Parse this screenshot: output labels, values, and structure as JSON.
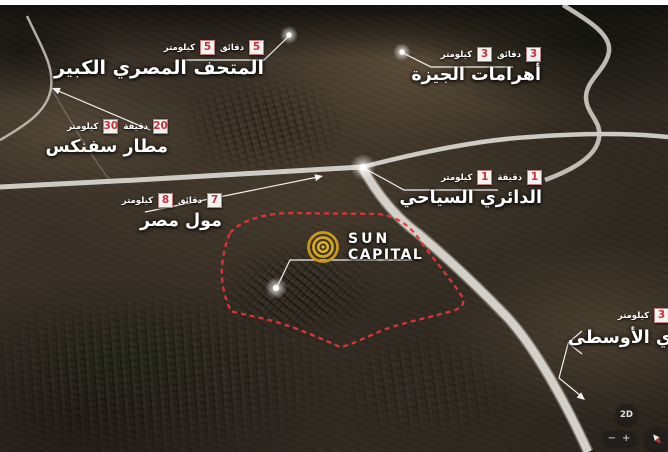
{
  "logo": {
    "line1": "SUN",
    "line2": "CAPITAL"
  },
  "landmarks": [
    {
      "id": "grand-egyptian-museum",
      "name": "المتحف المصري الكبير",
      "minutes": "5",
      "minutes_unit": "دقائق",
      "km": "5",
      "km_unit": "كيلومتر"
    },
    {
      "id": "giza-pyramids",
      "name": "أهرامات الجيزة",
      "minutes": "3",
      "minutes_unit": "دقائق",
      "km": "3",
      "km_unit": "كيلومتر"
    },
    {
      "id": "sphinx-airport",
      "name": "مطار سفنكس",
      "minutes": "20",
      "minutes_unit": "دقيقة",
      "km": "30",
      "km_unit": "كيلومتر"
    },
    {
      "id": "tourist-ring-road",
      "name": "الدائري السياحي",
      "minutes": "1",
      "minutes_unit": "دقيقة",
      "km": "1",
      "km_unit": "كيلومتر"
    },
    {
      "id": "mall-of-egypt",
      "name": "مول مصر",
      "minutes": "7",
      "minutes_unit": "دقائق",
      "km": "8",
      "km_unit": "كيلومتر"
    },
    {
      "id": "middle-ring-road",
      "name": "الدائري الأوسطى",
      "minutes": "3",
      "minutes_unit": "دقائق",
      "km": "3",
      "km_unit": "كيلومتر"
    }
  ],
  "controls": {
    "mode_2d": "2D",
    "zoom_out": "−",
    "zoom_in": "+"
  },
  "colors": {
    "badge_number": "#c4303c",
    "boundary_red": "#e33636",
    "road_gray": "#d8d5cf",
    "logo_gold": "#d2a11e",
    "label_text": "#ffffff"
  }
}
